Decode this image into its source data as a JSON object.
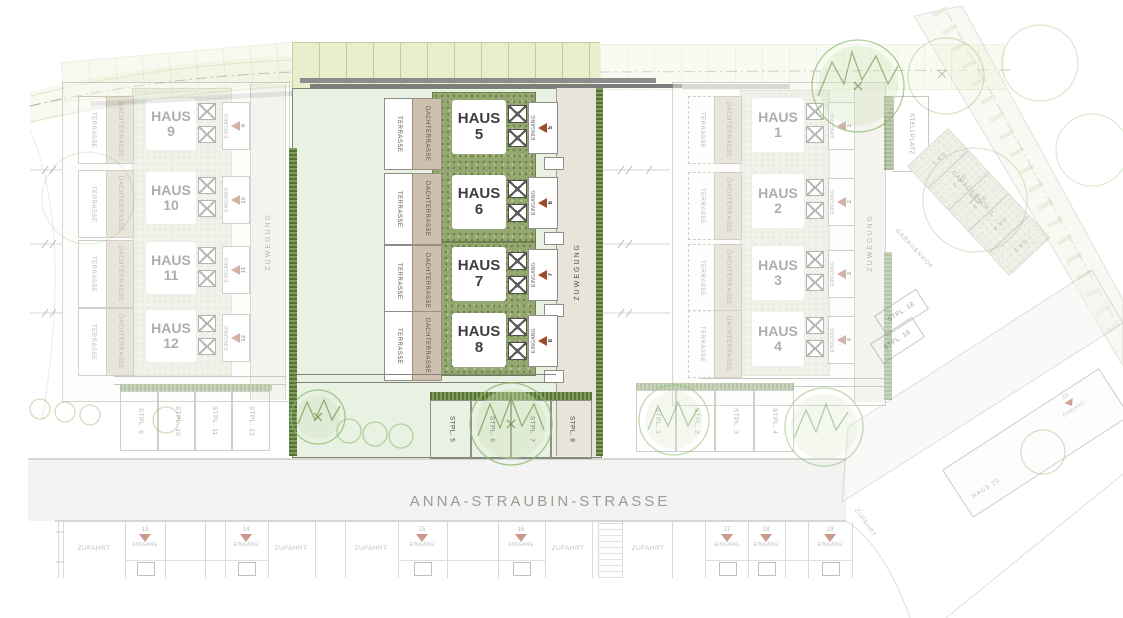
{
  "street": {
    "name": "ANNA-STRAUBIN-STRASSE"
  },
  "labels": {
    "haus": "HAUS",
    "terrasse": "TERRASSE",
    "dachterrasse": "DACHTERRASSE",
    "eingang": "EINGANG",
    "zuwegung": "ZUWEGUNG",
    "zufahrt": "ZUFAHRT",
    "stellplatz": "STELLPLATZ"
  },
  "blocks": {
    "center": {
      "houses": [
        {
          "label": "HAUS",
          "number": "5"
        },
        {
          "label": "HAUS",
          "number": "6"
        },
        {
          "label": "HAUS",
          "number": "7"
        },
        {
          "label": "HAUS",
          "number": "8"
        }
      ],
      "stalls": [
        "STPL. 5",
        "STPL. 6",
        "STPL. 7",
        "STPL. 8"
      ]
    },
    "west": {
      "houses": [
        {
          "label": "HAUS",
          "number": "9"
        },
        {
          "label": "HAUS",
          "number": "10"
        },
        {
          "label": "HAUS",
          "number": "11"
        },
        {
          "label": "HAUS",
          "number": "12"
        }
      ],
      "stalls": [
        "STPL. 9",
        "STPL. 10",
        "STPL. 11",
        "STPL. 12"
      ]
    },
    "east": {
      "houses": [
        {
          "label": "HAUS",
          "number": "1"
        },
        {
          "label": "HAUS",
          "number": "2"
        },
        {
          "label": "HAUS",
          "number": "3"
        },
        {
          "label": "HAUS",
          "number": "4"
        }
      ],
      "stalls": [
        "STPL. 1",
        "STPL. 2",
        "STPL. 3",
        "STPL. 4"
      ]
    }
  },
  "garage_court": {
    "name": "GARAGENHOF 1",
    "area_label": "GARAGENHOF",
    "stalls": [
      "GA 1",
      "GA 2",
      "GA 3",
      "GA 4",
      "GA 5"
    ],
    "visitor_stalls": [
      "STPL. 18",
      "STPL. 19"
    ]
  },
  "southeast": {
    "haus20": "HAUS 20",
    "entrance_number": "20",
    "road_label": "ZUFAHRT"
  },
  "south_strip": {
    "entrance_numbers": [
      "13",
      "14",
      "15",
      "16",
      "17",
      "18",
      "19"
    ]
  },
  "colors": {
    "garden_green": "#94a770",
    "garden_faded": "#dde2cf",
    "terrace_tan": "#cdc0ae",
    "path_beige": "#e9e4d9",
    "mint": "#e9f1e3",
    "field_band": "#e9eecd",
    "entrance_red": "#9c4a30",
    "hedge_green": "#567139",
    "tree_green": "#8fbc6f",
    "wall_gray": "#8d8d8d"
  }
}
